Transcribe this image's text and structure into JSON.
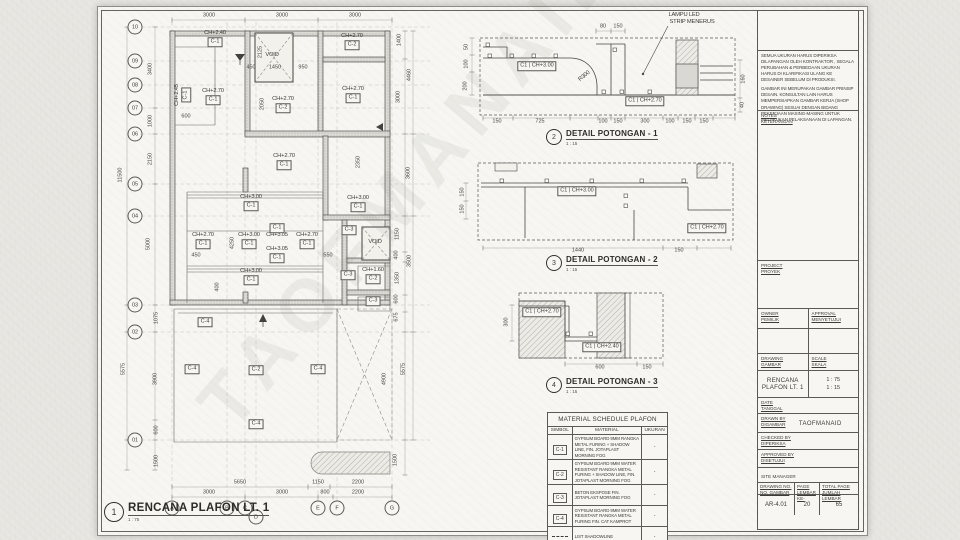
{
  "watermark": "TAOFMANAID",
  "colors": {
    "paper": "#e7e6e1",
    "sheet": "#f7f6f2",
    "ink": "#3e3c38",
    "wall_fill": "#dcdbd6",
    "light_line": "#a3a19b"
  },
  "plan": {
    "bubbles_rows": [
      {
        "t": "10",
        "x": 135,
        "y": 27
      },
      {
        "t": "09",
        "x": 135,
        "y": 61
      },
      {
        "t": "08",
        "x": 135,
        "y": 85
      },
      {
        "t": "07",
        "x": 135,
        "y": 108
      },
      {
        "t": "06",
        "x": 135,
        "y": 134
      },
      {
        "t": "05",
        "x": 135,
        "y": 184
      },
      {
        "t": "04",
        "x": 135,
        "y": 216
      },
      {
        "t": "03",
        "x": 135,
        "y": 305
      },
      {
        "t": "02",
        "x": 135,
        "y": 332
      },
      {
        "t": "01",
        "x": 135,
        "y": 440
      }
    ],
    "bubbles_cols": [
      {
        "t": "A",
        "x": 172,
        "y": 508
      },
      {
        "t": "B",
        "x": 227,
        "y": 508
      },
      {
        "t": "C",
        "x": 245,
        "y": 508
      },
      {
        "t": "D",
        "x": 256,
        "y": 517
      },
      {
        "t": "E",
        "x": 318,
        "y": 508
      },
      {
        "t": "F",
        "x": 337,
        "y": 508
      },
      {
        "t": "G",
        "x": 392,
        "y": 508
      }
    ],
    "dims": [
      {
        "t": "3000",
        "x": 209,
        "y": 16
      },
      {
        "t": "3000",
        "x": 282,
        "y": 16
      },
      {
        "t": "3000",
        "x": 355,
        "y": 16
      },
      {
        "t": "11500",
        "x": 121,
        "y": 175,
        "r": 90
      },
      {
        "t": "5575",
        "x": 124,
        "y": 369,
        "r": 90
      },
      {
        "t": "3400",
        "x": 151,
        "y": 69,
        "r": 90
      },
      {
        "t": "1000",
        "x": 151,
        "y": 121,
        "r": 90
      },
      {
        "t": "2150",
        "x": 151,
        "y": 159,
        "r": 90
      },
      {
        "t": "5000",
        "x": 149,
        "y": 244,
        "r": 90
      },
      {
        "t": "1075",
        "x": 157,
        "y": 318,
        "r": 90
      },
      {
        "t": "3900",
        "x": 156,
        "y": 379,
        "r": 90
      },
      {
        "t": "600",
        "x": 157,
        "y": 430,
        "r": 90
      },
      {
        "t": "1500",
        "x": 157,
        "y": 461,
        "r": 90
      },
      {
        "t": "600",
        "x": 186,
        "y": 117
      },
      {
        "t": "2125",
        "x": 261,
        "y": 52,
        "r": 90
      },
      {
        "t": "450",
        "x": 251,
        "y": 68
      },
      {
        "t": "1450",
        "x": 275,
        "y": 68
      },
      {
        "t": "950",
        "x": 303,
        "y": 68
      },
      {
        "t": "2050",
        "x": 263,
        "y": 104,
        "r": 90
      },
      {
        "t": "2350",
        "x": 359,
        "y": 162,
        "r": 90
      },
      {
        "t": "4250",
        "x": 233,
        "y": 243,
        "r": 90
      },
      {
        "t": "450",
        "x": 196,
        "y": 256
      },
      {
        "t": "550",
        "x": 328,
        "y": 256
      },
      {
        "t": "400",
        "x": 218,
        "y": 287,
        "r": 90
      },
      {
        "t": "1400",
        "x": 400,
        "y": 40,
        "r": 90
      },
      {
        "t": "4460",
        "x": 410,
        "y": 75,
        "r": 90
      },
      {
        "t": "3000",
        "x": 399,
        "y": 97,
        "r": 90
      },
      {
        "t": "3600",
        "x": 409,
        "y": 173,
        "r": 90
      },
      {
        "t": "1150",
        "x": 398,
        "y": 234,
        "r": 90
      },
      {
        "t": "400",
        "x": 397,
        "y": 255,
        "r": 90
      },
      {
        "t": "3500",
        "x": 410,
        "y": 261,
        "r": 90
      },
      {
        "t": "1350",
        "x": 398,
        "y": 278,
        "r": 90
      },
      {
        "t": "600",
        "x": 397,
        "y": 299,
        "r": 90
      },
      {
        "t": "675",
        "x": 397,
        "y": 317,
        "r": 90
      },
      {
        "t": "5575",
        "x": 404,
        "y": 369,
        "r": 90
      },
      {
        "t": "4900",
        "x": 385,
        "y": 379,
        "r": 90
      },
      {
        "t": "1500",
        "x": 396,
        "y": 460,
        "r": 90
      },
      {
        "t": "5650",
        "x": 240,
        "y": 483
      },
      {
        "t": "1150",
        "x": 318,
        "y": 483
      },
      {
        "t": "2200",
        "x": 358,
        "y": 483
      },
      {
        "t": "3000",
        "x": 209,
        "y": 493
      },
      {
        "t": "3000",
        "x": 282,
        "y": 493
      },
      {
        "t": "800",
        "x": 325,
        "y": 493
      },
      {
        "t": "2200",
        "x": 358,
        "y": 493
      }
    ],
    "labels": [
      {
        "t": "CH+2.40",
        "x": 215,
        "y": 34
      },
      {
        "t": "CH+2.70",
        "x": 352,
        "y": 37
      },
      {
        "t": "CH+2.45",
        "x": 178,
        "y": 95,
        "r": 90
      },
      {
        "t": "CH+2.70",
        "x": 213,
        "y": 92
      },
      {
        "t": "CH+2.70",
        "x": 283,
        "y": 100
      },
      {
        "t": "CH+2.70",
        "x": 353,
        "y": 90
      },
      {
        "t": "VOID",
        "x": 272,
        "y": 56
      },
      {
        "t": "CH+2.70",
        "x": 284,
        "y": 157
      },
      {
        "t": "CH+3.00",
        "x": 251,
        "y": 198
      },
      {
        "t": "CH+3.00",
        "x": 358,
        "y": 199
      },
      {
        "t": "CH+3.05",
        "x": 277,
        "y": 236
      },
      {
        "t": "CH+3.05",
        "x": 277,
        "y": 250
      },
      {
        "t": "CH+2.70",
        "x": 203,
        "y": 236
      },
      {
        "t": "CH+3.00",
        "x": 249,
        "y": 236
      },
      {
        "t": "CH+2.70",
        "x": 307,
        "y": 236
      },
      {
        "t": "CH+3.00",
        "x": 251,
        "y": 272
      },
      {
        "t": "CH+1.60",
        "x": 373,
        "y": 271
      },
      {
        "t": "VOID",
        "x": 375,
        "y": 243
      }
    ],
    "boxed": [
      {
        "t": "C-1",
        "x": 215,
        "y": 42
      },
      {
        "t": "C-2",
        "x": 352,
        "y": 45
      },
      {
        "t": "C-1",
        "x": 186,
        "y": 95,
        "r": 90
      },
      {
        "t": "C-1",
        "x": 213,
        "y": 100
      },
      {
        "t": "C-2",
        "x": 283,
        "y": 108
      },
      {
        "t": "C-1",
        "x": 353,
        "y": 98
      },
      {
        "t": "C-1",
        "x": 284,
        "y": 165
      },
      {
        "t": "C-1",
        "x": 251,
        "y": 206
      },
      {
        "t": "C-1",
        "x": 358,
        "y": 207
      },
      {
        "t": "C-1",
        "x": 277,
        "y": 228
      },
      {
        "t": "C-1",
        "x": 277,
        "y": 258
      },
      {
        "t": "C-1",
        "x": 203,
        "y": 244
      },
      {
        "t": "C-1",
        "x": 249,
        "y": 244
      },
      {
        "t": "C-1",
        "x": 307,
        "y": 244
      },
      {
        "t": "C-1",
        "x": 251,
        "y": 280
      },
      {
        "t": "C-3",
        "x": 349,
        "y": 230
      },
      {
        "t": "C-3",
        "x": 348,
        "y": 275
      },
      {
        "t": "C-2",
        "x": 373,
        "y": 279
      },
      {
        "t": "C-3",
        "x": 373,
        "y": 301
      },
      {
        "t": "C-4",
        "x": 205,
        "y": 322
      },
      {
        "t": "C-4",
        "x": 192,
        "y": 369
      },
      {
        "t": "C-2",
        "x": 256,
        "y": 370
      },
      {
        "t": "C-4",
        "x": 318,
        "y": 369
      },
      {
        "t": "C-4",
        "x": 256,
        "y": 424
      }
    ]
  },
  "details": [
    {
      "num": "2",
      "title": "DETAIL POTONGAN - 1",
      "scale": "1 : 15",
      "tx": 545,
      "ty": 137,
      "plain": [
        {
          "t": "LAMPU LED",
          "x": 684,
          "y": 16
        },
        {
          "t": "STRIP MENERUS",
          "x": 692,
          "y": 23
        },
        {
          "t": "R300",
          "x": 585,
          "y": 77,
          "r": 40
        }
      ],
      "boxed": [
        {
          "t": "C1 | CH+3.00",
          "x": 537,
          "y": 66
        },
        {
          "t": "C1 | CH+2.70",
          "x": 645,
          "y": 101
        }
      ],
      "dims": [
        {
          "t": "80",
          "x": 603,
          "y": 27
        },
        {
          "t": "150",
          "x": 618,
          "y": 27
        },
        {
          "t": "50",
          "x": 467,
          "y": 47,
          "r": 90
        },
        {
          "t": "100",
          "x": 467,
          "y": 64,
          "r": 90
        },
        {
          "t": "200",
          "x": 466,
          "y": 86,
          "r": 90
        },
        {
          "t": "160",
          "x": 744,
          "y": 79,
          "r": 90
        },
        {
          "t": "40",
          "x": 743,
          "y": 105,
          "r": 90
        },
        {
          "t": "150",
          "x": 497,
          "y": 122
        },
        {
          "t": "725",
          "x": 540,
          "y": 122
        },
        {
          "t": "100",
          "x": 603,
          "y": 122
        },
        {
          "t": "150",
          "x": 618,
          "y": 122
        },
        {
          "t": "300",
          "x": 645,
          "y": 122
        },
        {
          "t": "100",
          "x": 670,
          "y": 122
        },
        {
          "t": "150",
          "x": 687,
          "y": 122
        },
        {
          "t": "150",
          "x": 704,
          "y": 122
        }
      ]
    },
    {
      "num": "3",
      "title": "DETAIL POTONGAN - 2",
      "scale": "1 : 15",
      "tx": 545,
      "ty": 263,
      "plain": [],
      "boxed": [
        {
          "t": "C1 | CH+3.00",
          "x": 577,
          "y": 191
        },
        {
          "t": "C1 | CH+2.70",
          "x": 707,
          "y": 228
        }
      ],
      "dims": [
        {
          "t": "150",
          "x": 463,
          "y": 192,
          "r": 90
        },
        {
          "t": "150",
          "x": 463,
          "y": 209,
          "r": 90
        },
        {
          "t": "1440",
          "x": 578,
          "y": 251
        },
        {
          "t": "150",
          "x": 679,
          "y": 251
        }
      ]
    },
    {
      "num": "4",
      "title": "DETAIL POTONGAN - 3",
      "scale": "1 : 15",
      "tx": 545,
      "ty": 385,
      "plain": [],
      "boxed": [
        {
          "t": "C1 | CH+2.70",
          "x": 542,
          "y": 312
        },
        {
          "t": "C1 | CH+2.40",
          "x": 602,
          "y": 347
        }
      ],
      "dims": [
        {
          "t": "300",
          "x": 507,
          "y": 322,
          "r": 90
        },
        {
          "t": "600",
          "x": 600,
          "y": 368
        },
        {
          "t": "150",
          "x": 647,
          "y": 368
        }
      ]
    }
  ],
  "view_titles": [
    {
      "num": "1",
      "label": "RENCANA PLAFON LT. 1",
      "scale": "1 : 75",
      "x": 104,
      "y": 512,
      "big": true
    },
    {
      "num": "2",
      "label": "DETAIL POTONGAN - 1",
      "scale": "1 : 15",
      "x": 546,
      "y": 137,
      "big": false
    },
    {
      "num": "3",
      "label": "DETAIL POTONGAN - 2",
      "scale": "1 : 15",
      "x": 546,
      "y": 263,
      "big": false
    },
    {
      "num": "4",
      "label": "DETAIL POTONGAN - 3",
      "scale": "1 : 15",
      "x": 546,
      "y": 385,
      "big": false
    }
  ],
  "schedule": {
    "title": "MATERIAL SCHEDULE PLAFON",
    "columns": [
      "SIMBOL",
      "MATERIAL",
      "UKURAN"
    ],
    "rows": [
      {
        "sym": "C-1",
        "dash": false,
        "material": "GYPSUM BOARD 9MM RANGKA METAL FURING + SHADOW LINE, FIN. JOTAPLAST MORNING FOG",
        "size": "-"
      },
      {
        "sym": "C-2",
        "dash": false,
        "material": "GYPSUM BOARD 9MM WATER RESISTANT RANGKA METAL FURING + SHADOW LINE, FIN. JOTAPLAST MORNING FOG",
        "size": "-"
      },
      {
        "sym": "C-3",
        "dash": false,
        "material": "BETON EKSPOSE FIN. JOTAPLAST MORNING FOG",
        "size": "-"
      },
      {
        "sym": "C-4",
        "dash": false,
        "material": "GYPSUM BOARD 9MM WATER RESISTANT RANGKA METAL FURING FIN. CAT KAMPROT",
        "size": "-"
      },
      {
        "sym": "",
        "dash": true,
        "material": "LIST SHADOWLINE",
        "size": "-"
      }
    ]
  },
  "titleblock": {
    "note1": "SEMUA UKURAN HARUS DIPERIKSA DILAPANGAN OLEH KONTRAKTOR , SEGALA PERUBAHAN & PERBEDAAN UKURAN HARUS DI KLARIFIKASI ULANG KE DESAINER SEBELUM DI PRODUKSI.",
    "note2": "GAMBAR INI MERUPAKAN GAMBAR PRINSIP DESAIN. KONSULTAN LAIN HARUS MEMPERSIAPKAN GAMBAR KERJA (SHOP DRAWING) SESUAI DENGAN BIDANG PEKERJAAN MASING-MASING UNTUK MELAKUKAN PELAKSANAAN DI LAPANGAN.",
    "notes_label": "NOTES",
    "notes_label2": "KETERANGAN",
    "project_label": "PROJECT",
    "project_label2": "PROYEK",
    "owner_label": "OWNER",
    "owner_label2": "PEMILIK",
    "approval_label": "APPROVAL",
    "approval_label2": "MENYETUJUI",
    "drawing_label": "DRAWING",
    "drawing_label2": "GAMBAR",
    "scale_label": "SCALE",
    "scale_label2": "SKALA",
    "drawing_name": "RENCANA PLAFON LT. 1",
    "scale_value1": "1 : 75",
    "scale_value2": "1 : 15",
    "date_label": "DATE",
    "date_label2": "TANGGAL",
    "drawn_label": "DRAWN BY",
    "drawn_label2": "DIGAMBAR",
    "drawn_value": "TAOFMANAID",
    "checked_label": "CHECKED BY",
    "checked_label2": "DIPERIKSA",
    "approved_label": "APPROVED BY",
    "approved_label2": "DISETUJUI",
    "site_label": "SITE MANAGER",
    "no_label": "DRAWING NO.",
    "no_label2": "NO. GAMBAR",
    "no_value": "AR-4.01",
    "page_label": "PAGE",
    "page_label2": "LEMBAR KE-",
    "page_value": "20",
    "total_label": "TOTAL PAGE",
    "total_label2": "JUMLAH LEMBAR",
    "total_value": "65"
  }
}
